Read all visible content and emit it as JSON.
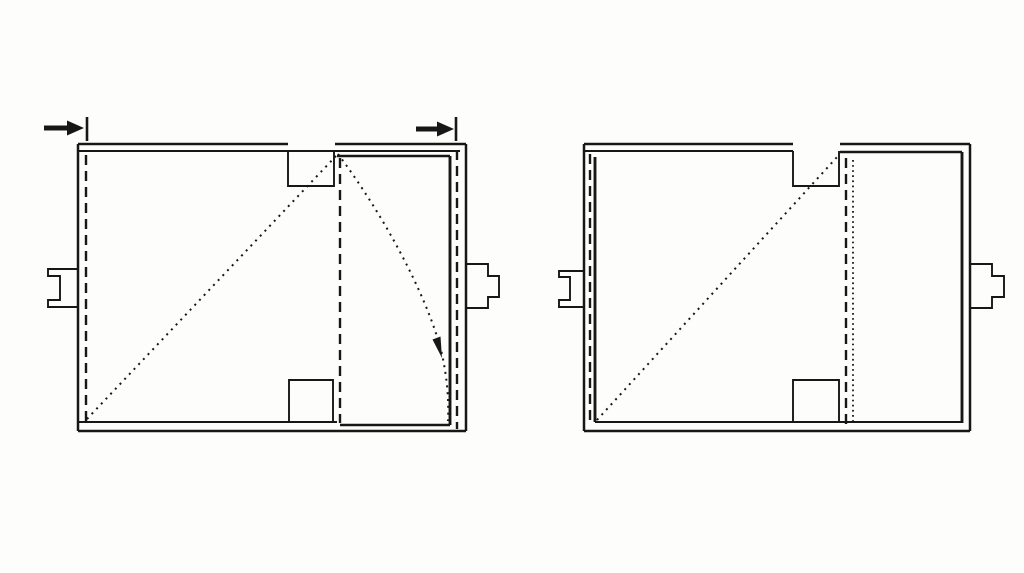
{
  "canvas": {
    "width": 1024,
    "height": 573,
    "background": "#fdfdfc"
  },
  "colors": {
    "ink": "#171717"
  },
  "strokes": {
    "main": {
      "width": 2.5,
      "dash": null
    },
    "thin": {
      "width": 1.9,
      "dash": null
    },
    "thick": {
      "width": 2.9,
      "dash": null
    },
    "heavy": {
      "width": 5.0,
      "dash": null
    },
    "tick": {
      "width": 2.6,
      "dash": null
    },
    "dashed": {
      "width": 2.4,
      "dash": "10 6"
    },
    "dotted": {
      "width": 2.0,
      "dash": "2 4.8"
    },
    "dotted-dense": {
      "width": 1.8,
      "dash": "1.7 3.4"
    }
  },
  "figures": [
    {
      "name": "figure-left-flap-closing",
      "shapes": [
        {
          "name": "top-wall-outer-left-segment",
          "kind": "path",
          "d": "M78,144 H288",
          "stroke": "main"
        },
        {
          "name": "top-wall-outer-right-segment",
          "kind": "path",
          "d": "M335,144 H466",
          "stroke": "main"
        },
        {
          "name": "top-wall-inner-line",
          "kind": "path",
          "d": "M78,151 H460",
          "stroke": "thin"
        },
        {
          "name": "left-wall-line",
          "kind": "path",
          "d": "M78,144 V431",
          "stroke": "main"
        },
        {
          "name": "left-fold-hidden-line",
          "kind": "path",
          "d": "M86,155 V421",
          "stroke": "dashed"
        },
        {
          "name": "top-notch-outline",
          "kind": "path",
          "d": "M288,151 V186 H334 V151",
          "stroke": "thin"
        },
        {
          "name": "flap-top-edge",
          "kind": "path",
          "d": "M337,156 H450",
          "stroke": "main"
        },
        {
          "name": "flap-right-edge",
          "kind": "path",
          "d": "M450,156 V425",
          "stroke": "thick"
        },
        {
          "name": "right-fold-hidden-line",
          "kind": "path",
          "d": "M457,150 V429",
          "stroke": "dashed"
        },
        {
          "name": "right-wall-line",
          "kind": "path",
          "d": "M466,144 V431",
          "stroke": "main"
        },
        {
          "name": "bottom-wall-inner-line",
          "kind": "path",
          "d": "M78,422 H337",
          "stroke": "thin"
        },
        {
          "name": "flap-bottom-edge",
          "kind": "path",
          "d": "M340,425 H450",
          "stroke": "main"
        },
        {
          "name": "bottom-wall-outer-line",
          "kind": "path",
          "d": "M78,431 H466",
          "stroke": "main"
        },
        {
          "name": "bottom-notch-outline",
          "kind": "path",
          "d": "M289,422 V380 H333 V422",
          "stroke": "thin"
        },
        {
          "name": "center-fold-hidden-line",
          "kind": "path",
          "d": "M340,158 V423",
          "stroke": "dashed"
        },
        {
          "name": "diagonal-fold-dotted-line",
          "kind": "path",
          "d": "M87,419 L336,156",
          "stroke": "dotted"
        },
        {
          "name": "flap-swing-arc-dotted",
          "kind": "path",
          "d": "M338,154 C380,210 425,290 441,350 C447,375 449,400 448,421",
          "stroke": "dotted"
        },
        {
          "name": "swing-direction-arrowhead-icon",
          "kind": "polygon",
          "points": "442,358 440.5,336.5 432.5,339.5",
          "fill": true
        },
        {
          "name": "left-latch-tab-outline",
          "kind": "path",
          "d": "M78,269 H48 V276 H60 V300 H48 V307 H78",
          "stroke": "thin"
        },
        {
          "name": "right-latch-tab-outline",
          "kind": "path",
          "d": "M466,264 H488 V276 H499 V297 H488 V308 H466",
          "stroke": "thin"
        },
        {
          "name": "left-direction-arrow-shaft",
          "kind": "path",
          "d": "M44,128 H68",
          "stroke": "heavy"
        },
        {
          "name": "left-direction-arrow-head-icon",
          "kind": "polygon",
          "points": "67,120.5 67,135.5 84,128",
          "fill": true
        },
        {
          "name": "left-reference-tick-mark",
          "kind": "path",
          "d": "M87,117 V141",
          "stroke": "tick"
        },
        {
          "name": "right-direction-arrow-shaft",
          "kind": "path",
          "d": "M416,129 H438",
          "stroke": "heavy"
        },
        {
          "name": "right-direction-arrow-head-icon",
          "kind": "polygon",
          "points": "437,121.5 437,136.5 454,129",
          "fill": true
        },
        {
          "name": "right-reference-tick-mark",
          "kind": "path",
          "d": "M456,117 V141",
          "stroke": "tick"
        }
      ]
    },
    {
      "name": "figure-right-flap-closed",
      "shapes": [
        {
          "name": "top-wall-outer-left-segment",
          "kind": "path",
          "d": "M584,144 H793",
          "stroke": "main"
        },
        {
          "name": "top-wall-outer-right-segment",
          "kind": "path",
          "d": "M840,144 H970",
          "stroke": "main"
        },
        {
          "name": "top-wall-inner-line",
          "kind": "path",
          "d": "M584,151 H793",
          "stroke": "thin"
        },
        {
          "name": "left-wall-line",
          "kind": "path",
          "d": "M584,144 V431",
          "stroke": "main"
        },
        {
          "name": "left-fold-hidden-line",
          "kind": "path",
          "d": "M590,154 V424",
          "stroke": "dashed"
        },
        {
          "name": "folded-flap-left-edge",
          "kind": "path",
          "d": "M595,157 V422",
          "stroke": "thick"
        },
        {
          "name": "top-notch-outline",
          "kind": "path",
          "d": "M793,151 V186 H839 V151",
          "stroke": "thin"
        },
        {
          "name": "flap-top-edge",
          "kind": "path",
          "d": "M840,152 H962",
          "stroke": "main"
        },
        {
          "name": "flap-right-edge",
          "kind": "path",
          "d": "M962,152 V423",
          "stroke": "thick"
        },
        {
          "name": "right-wall-line",
          "kind": "path",
          "d": "M970,144 V431",
          "stroke": "main"
        },
        {
          "name": "bottom-wall-inner-line",
          "kind": "path",
          "d": "M595,422 H962",
          "stroke": "thin"
        },
        {
          "name": "bottom-wall-outer-line",
          "kind": "path",
          "d": "M584,431 H970",
          "stroke": "main"
        },
        {
          "name": "bottom-notch-outline",
          "kind": "path",
          "d": "M793,422 V380 H839 V422",
          "stroke": "thin"
        },
        {
          "name": "center-fold-hidden-line",
          "kind": "path",
          "d": "M846,158 V424",
          "stroke": "dashed"
        },
        {
          "name": "flap-edge-dotted-line",
          "kind": "path",
          "d": "M853,160 V422",
          "stroke": "dotted-dense"
        },
        {
          "name": "diagonal-fold-dotted-line",
          "kind": "path",
          "d": "M597,420 L838,156",
          "stroke": "dotted"
        },
        {
          "name": "left-latch-tab-outline",
          "kind": "path",
          "d": "M584,271 H559 V277 H570 V300 H559 V307 H584",
          "stroke": "thin"
        },
        {
          "name": "right-latch-tab-outline",
          "kind": "path",
          "d": "M970,264 H992 V276 H1004 V297 H992 V308 H970",
          "stroke": "thin"
        }
      ]
    }
  ]
}
